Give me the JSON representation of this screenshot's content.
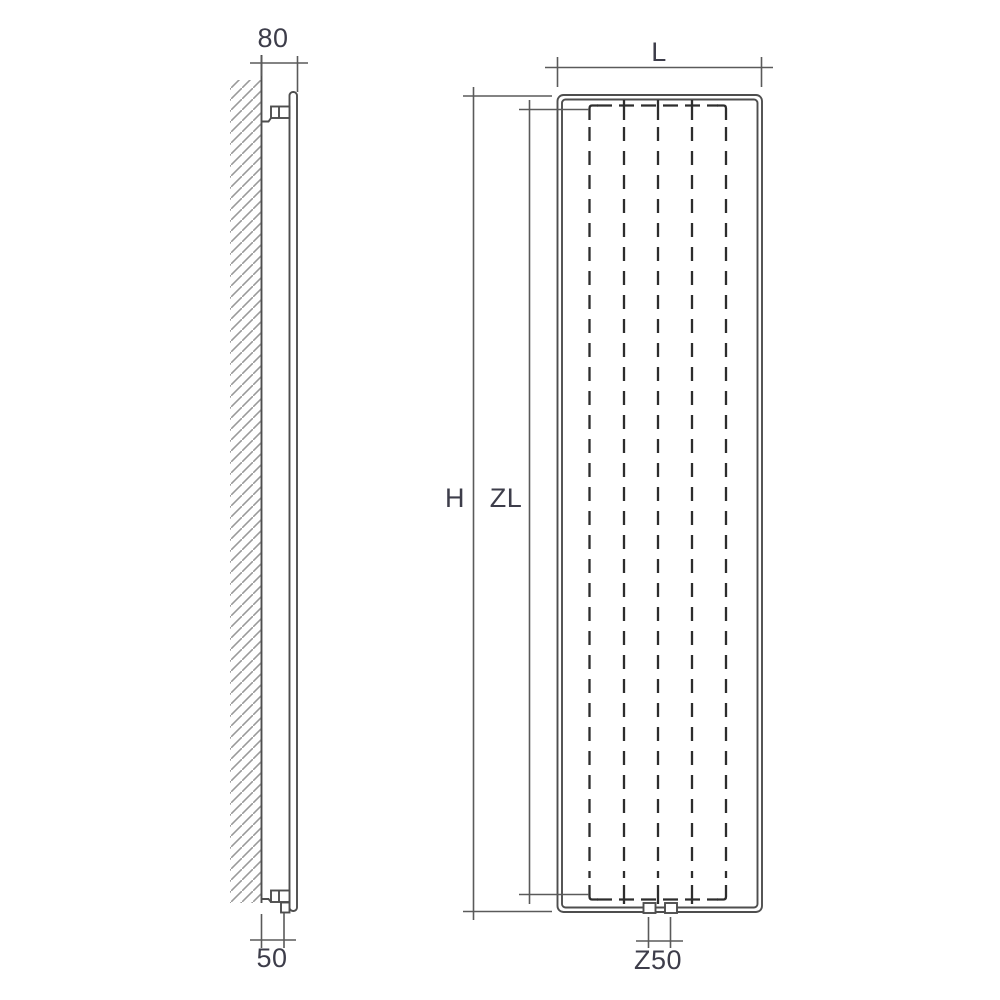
{
  "drawing": {
    "kind": "radiator-dimension-diagram",
    "labels": {
      "depth": "80",
      "wall_to_connection": "50",
      "width": "L",
      "height": "H",
      "hub_length": "ZL",
      "connection_spacing": "Z50"
    },
    "views": {
      "side": {
        "parts": [
          "wall-hatching",
          "wall-face",
          "radiator-panel",
          "top-bracket",
          "bottom-bracket",
          "pipe-connection"
        ]
      },
      "front": {
        "channel_count": 5,
        "bottom_connection_count": 2,
        "parts": [
          "outer-frame",
          "inner-frame",
          "hidden-water-channels",
          "bottom-connections"
        ]
      }
    },
    "colors": {
      "background": "#ffffff",
      "outline": "#4e4e4e",
      "dimension_line": "#5a5a5a",
      "hidden_line": "#2d2d2d",
      "hatch": "#9a9a9a",
      "label_text": "#3d3d4a"
    }
  }
}
